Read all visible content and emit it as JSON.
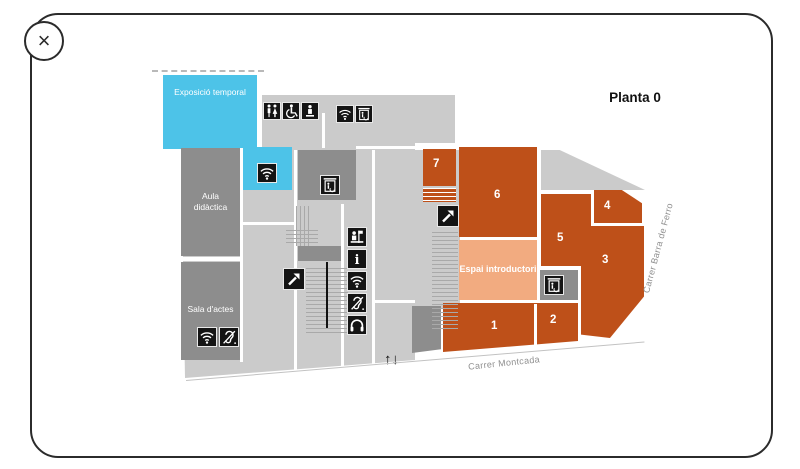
{
  "window": {
    "close_button": "×"
  },
  "title": "Planta 0",
  "map": {
    "areas": {
      "temporary_exhibition": {
        "label": "Exposició temporal"
      },
      "aula_didactica": {
        "label_line1": "Aula",
        "label_line2": "didàctica"
      },
      "sala_actes": {
        "label": "Sala d'actes"
      },
      "espai_introductori": {
        "label": "Espai introductori"
      }
    },
    "rooms": [
      {
        "number": "1"
      },
      {
        "number": "2"
      },
      {
        "number": "3"
      },
      {
        "number": "4"
      },
      {
        "number": "5"
      },
      {
        "number": "6"
      },
      {
        "number": "7"
      }
    ],
    "streets": {
      "south": "Carrer Montcada",
      "east": "Carrer Barra de Ferro"
    },
    "entrance_arrows": "↑↓",
    "colors": {
      "exhibition_rooms": "#BE5019",
      "temporary_exhibition": "#4DC3E8",
      "intro_space": "#F2AB80",
      "service_rooms": "#8D8D8D",
      "floor": "#CBCBCB"
    },
    "icons": [
      "toilets-icon",
      "accessible-toilet-icon",
      "drinking-fountain-icon",
      "wifi-icon",
      "elevator-icon",
      "escalator-icon",
      "ticket-desk-icon",
      "info-icon",
      "hearing-loop-icon",
      "audio-guide-icon"
    ]
  }
}
